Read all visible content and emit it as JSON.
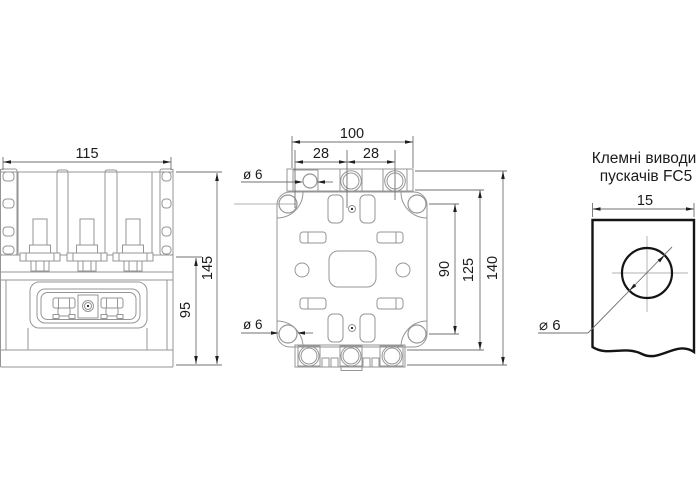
{
  "colors": {
    "background": "#ffffff",
    "line": "#969696",
    "dim_line": "#707070",
    "arrow": "#1e1e1e",
    "text": "#1b1b1b",
    "thick_line": "#141414"
  },
  "front_view": {
    "dim_width": "115",
    "dim_height_total": "145",
    "dim_height_mount": "95"
  },
  "mounting_view": {
    "dim_width": "100",
    "dim_pitch_left": "28",
    "dim_pitch_right": "28",
    "dim_hole_top": "ø 6",
    "dim_hole_bottom": "ø 6",
    "dim_holes_span": "90",
    "dim_body_height": "125",
    "dim_total_height": "140"
  },
  "terminal_view": {
    "title_line1": "Клемні виводи",
    "title_line2": "пускачів FC5",
    "dim_width": "15",
    "dim_hole": "⌀ 6"
  }
}
